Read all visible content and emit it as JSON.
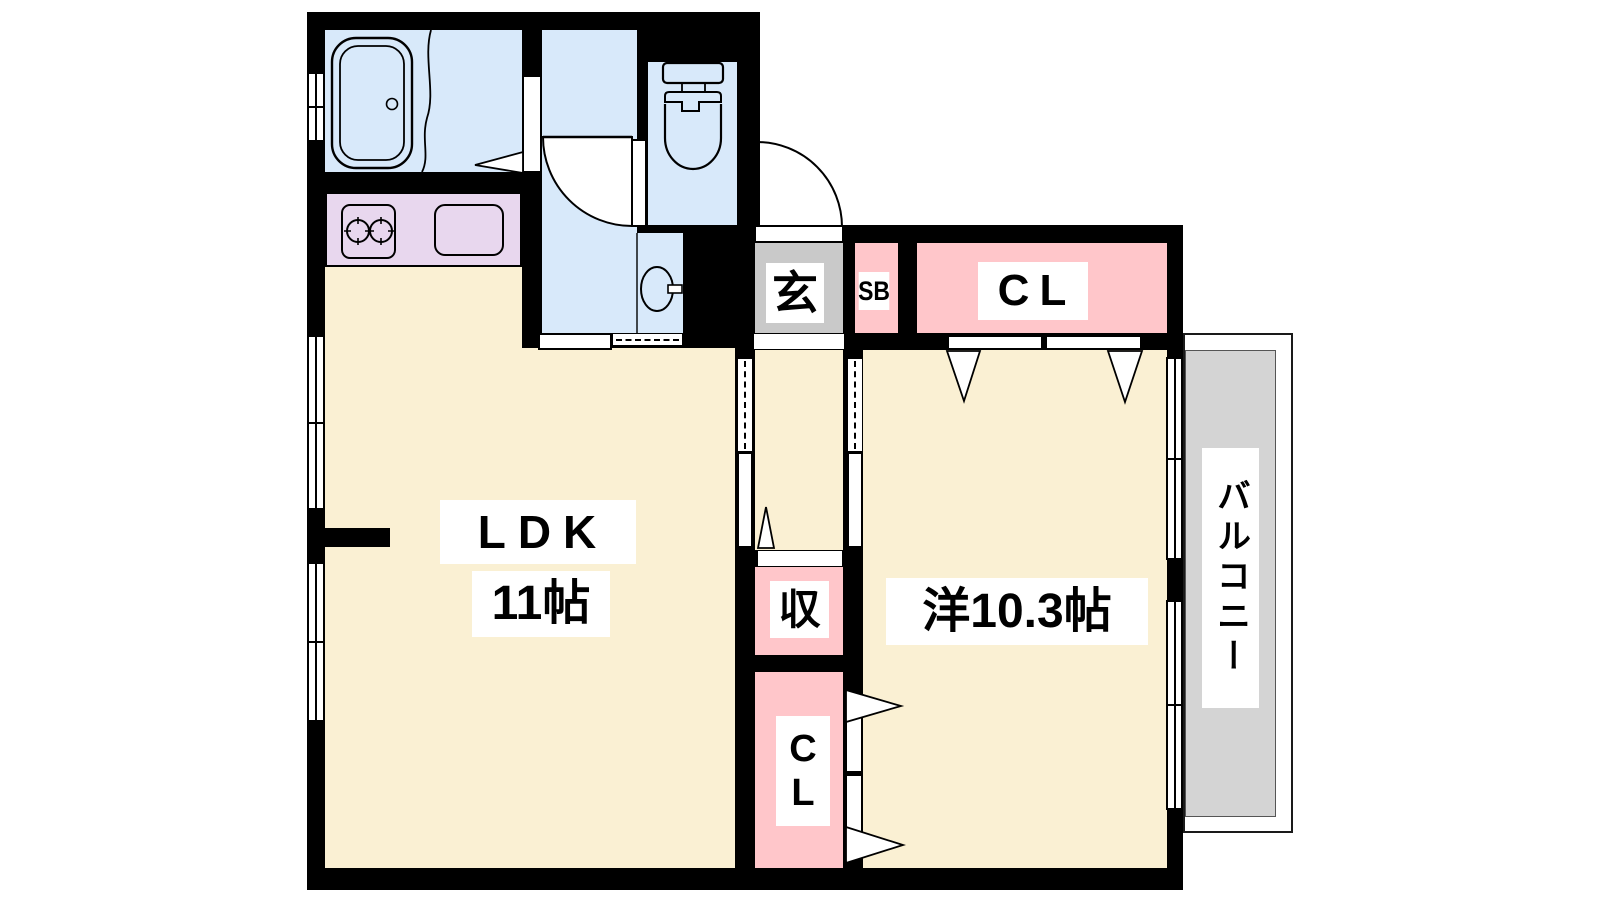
{
  "plan_type": "floor-plan",
  "rooms": {
    "ldk": {
      "label": "LDK",
      "size": "11帖"
    },
    "western_room": {
      "label": "洋10.3帖"
    },
    "entrance": {
      "label": "玄"
    },
    "shoe_box": {
      "label": "SB"
    },
    "closet_upper": {
      "label": "CL"
    },
    "storage": {
      "label": "収"
    },
    "closet_lower": {
      "char1": "C",
      "char2": "L"
    },
    "balcony": {
      "label": "バルコニー"
    }
  },
  "palette": {
    "floor_cream": "#FAF0D3",
    "closet_pink": "#FFC6CA",
    "water_blue": "#D8E9FA",
    "kitchen_lavender": "#E8D7EE",
    "entrance_gray": "#C9C9C9",
    "balcony_gray": "#D4D4D4",
    "wall_black": "#000000",
    "label_bg": "#FFFFFF",
    "text": "#000000"
  }
}
